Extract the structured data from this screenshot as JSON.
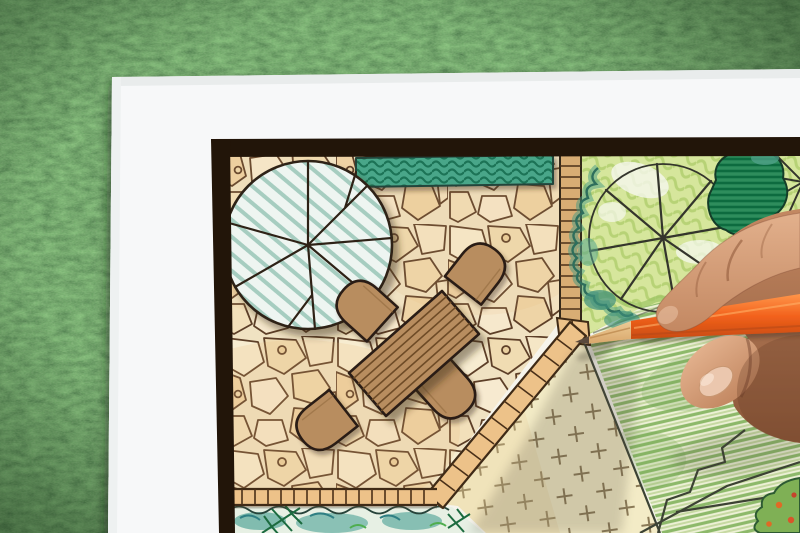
{
  "scene": {
    "description": "Close-up photo of a hand holding an orange colored pencil, drawing a garden landscape architecture plan on white paper that lies on green grass",
    "elements": {
      "grass": "artificial green grass background",
      "paper": "white drawing paper sheet",
      "frame": "thick dark plan border frame",
      "patio": "flagstone patio paving",
      "hedge": "green hedge strip along top wall",
      "round_tree": "large round tree canopy symbol with radial branches",
      "table": "rectangular wooden dining table, plan view",
      "chairs": "four rounded patio chairs around the table",
      "tile_edge": "small tile mow-strip border between patio and beds",
      "right_bed": "planting bed with two tree canopy symbols and shrubs",
      "dark_shrub": "dark green hatched shrub",
      "cross_lawn": "groundcover area marked with small crosses",
      "striped_lawn": "lawn colored with diagonal green pencil strokes",
      "bottom_bed": "planting bed with conifer sprigs along bottom edge",
      "corner_flowers": "small flower bed in bottom-right corner",
      "hand": "hand gripping the pencil",
      "pencil": "orange colored pencil with sharpened wooden tip"
    },
    "counts": {
      "chairs": 4,
      "tree_canopies": 3
    }
  },
  "palette": {
    "grassBase": "#4e7a41",
    "paper": "#f7f8f9",
    "frame": "#221509",
    "stoneBg": "#f0e2c2",
    "stoneLine": "#5d3f28",
    "hedge": "#4aa689",
    "mintBg": "#eef5f1",
    "mintLine": "#a6cdc0",
    "wood": "#b88d5f",
    "woodLine": "#2b1f12",
    "tile": "#edc289",
    "tileLine": "#3f2a16",
    "bedGround": "#d6e69c",
    "treeLine": "#34352c",
    "tealScrib": "#2e6e5c",
    "darkShrub": "#2e8d5c",
    "lawnPale": "#f3ebc6",
    "stripeBg": "#edf1d6",
    "stripeGreen": "#8db96a",
    "pencil": "#f2611c",
    "pencilLight": "#ff9549",
    "pencilWood": "#d9a76b",
    "skin": "#e2b08c",
    "skinMid": "#c38862",
    "skinDark": "#8a5638"
  }
}
